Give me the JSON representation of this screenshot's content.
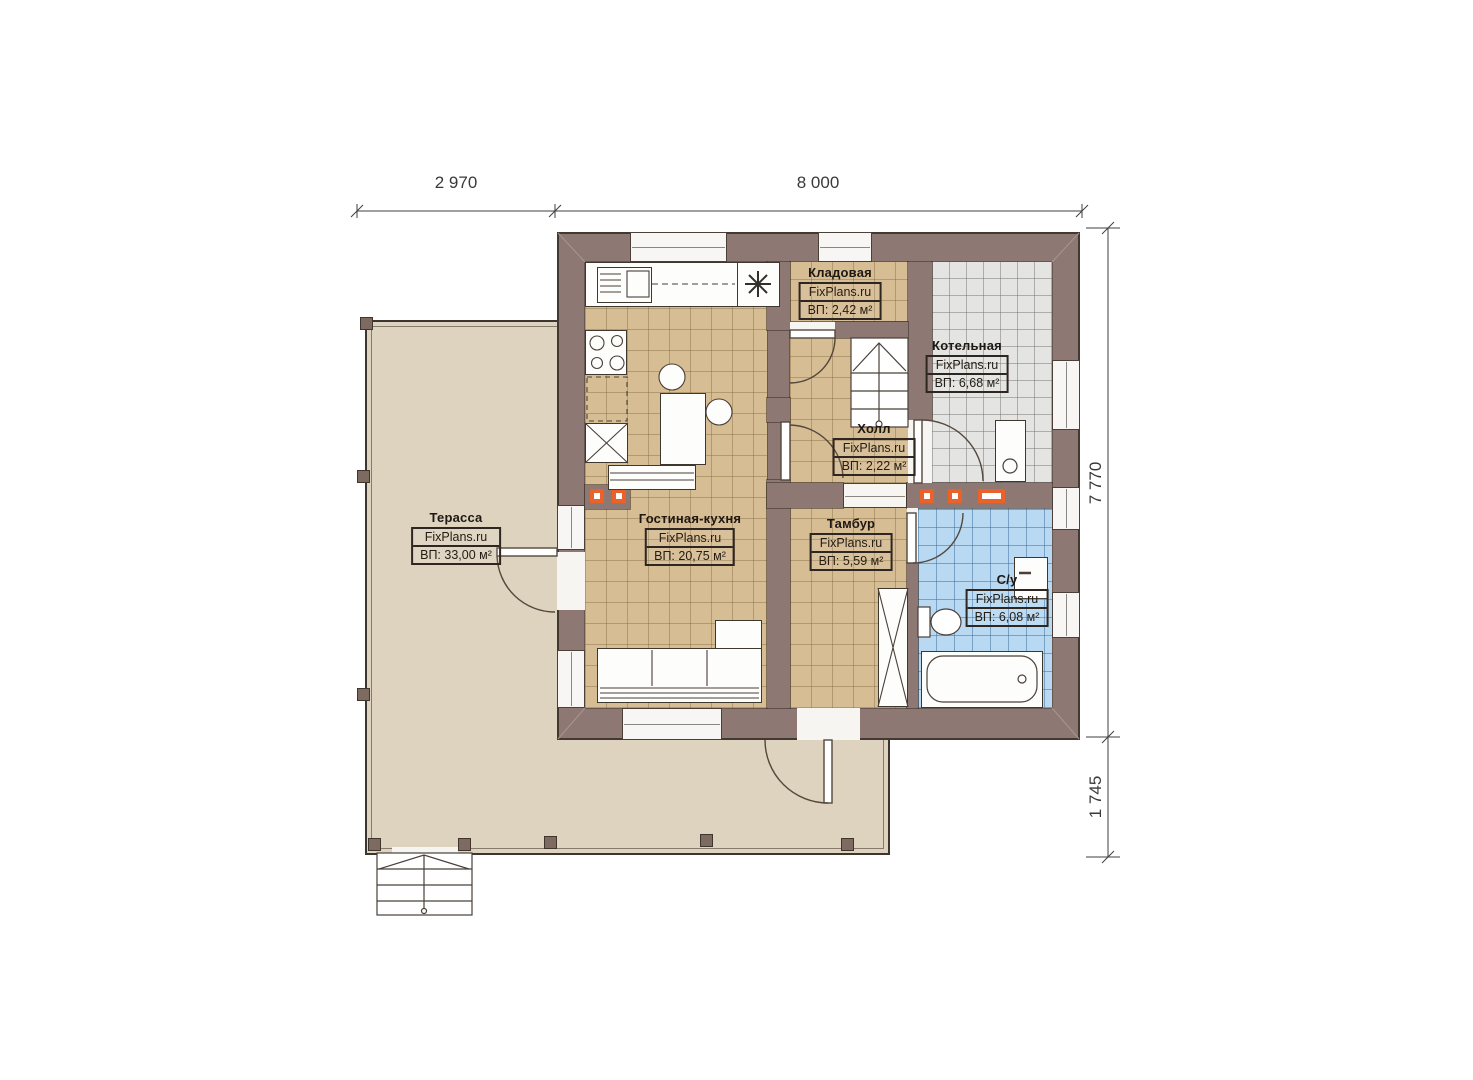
{
  "palette": {
    "wall": "#8d7873",
    "floor_tan": "#d6bd94",
    "floor_gray": "#e4e4e2",
    "floor_blue": "#b9d9f2",
    "terrace_floor": "#ded3bf",
    "accent_orange": "#e8622a"
  },
  "dimensions": {
    "top": [
      {
        "label": "2 970"
      },
      {
        "label": "8 000"
      }
    ],
    "right": [
      {
        "label": "7 770"
      },
      {
        "label": "1 745"
      }
    ]
  },
  "rooms": {
    "terrace": {
      "name": "Терасса",
      "brand": "FixPlans.ru",
      "area": "ВП: 33,00 м²"
    },
    "living_kitchen": {
      "name": "Гостиная-кухня",
      "brand": "FixPlans.ru",
      "area": "ВП: 20,75 м²"
    },
    "storage": {
      "name": "Кладовая",
      "brand": "FixPlans.ru",
      "area": "ВП: 2,42 м²"
    },
    "boiler": {
      "name": "Котельная",
      "brand": "FixPlans.ru",
      "area": "ВП: 6,68 м²"
    },
    "hall": {
      "name": "Холл",
      "brand": "FixPlans.ru",
      "area": "ВП: 2,22 м²"
    },
    "vestibule": {
      "name": "Тамбур",
      "brand": "FixPlans.ru",
      "area": "ВП: 5,59 м²"
    },
    "bathroom": {
      "name": "С/у",
      "brand": "FixPlans.ru",
      "area": "ВП: 6,08 м²"
    }
  }
}
